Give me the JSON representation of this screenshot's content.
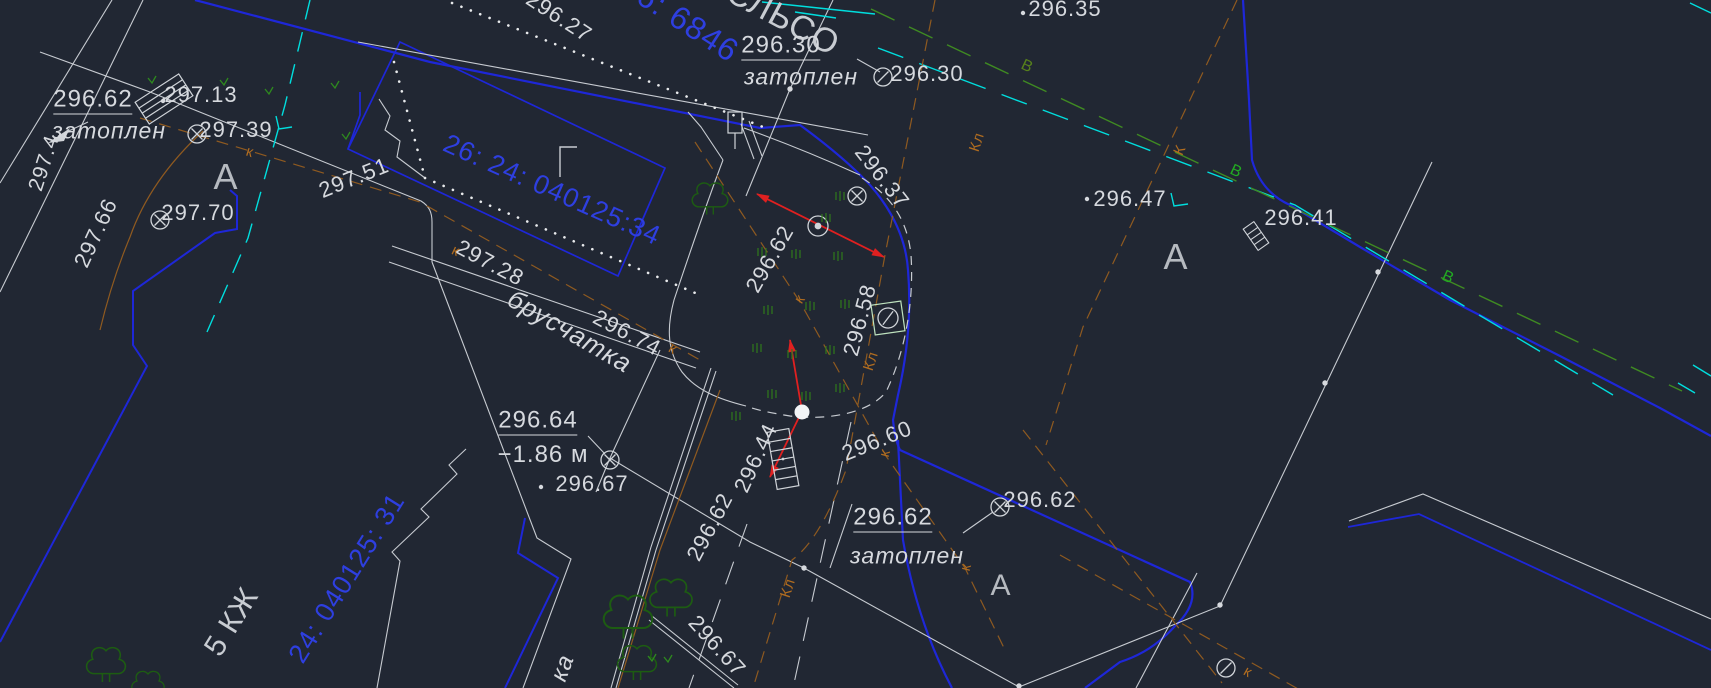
{
  "app": {
    "description": "CAD topographic survey plan viewport (dark theme), Russian annotations",
    "canvas": {
      "width": 1711,
      "height": 688,
      "background": "#212733"
    }
  },
  "colors": {
    "background": "#212733",
    "label_white": "#d6d9de",
    "label_letter": "#b6bac0",
    "line_white": "#c7cbd1",
    "blue_line": "#1e27d8",
    "blue_text": "#2e3fe0",
    "cyan": "#00dede",
    "green_line": "#3f8a22",
    "green_label_bright": "#22aa22",
    "green_label_olive": "#56801c",
    "tree_green": "#1d5c12",
    "grass_green": "#2f7a1c",
    "brown_line": "#8f5a20",
    "brown_label": "#b06c20",
    "red": "#e02020"
  },
  "icons": {
    "manhole-cross": "circle with diagonal cross — utility manhole",
    "manhole-slash": "circle with diagonal slash — utility manhole",
    "benchmark": "double concentric circle — survey point",
    "valve-square": "square with slashed circle — valve chamber",
    "steps": "hatched rectangle — steps / grate",
    "post": "small rectangle with stem — post / sign",
    "water-dot": "filled white dot — flooded point",
    "tree": "deciduous tree outline",
    "tuft": "grass tuft strokes",
    "vmark": "vegetation check mark",
    "corner-mark": "building corner letter mark"
  },
  "labels": [
    {
      "name": "elev-296-62-tl",
      "text": "296.62",
      "x": 93,
      "y": 101,
      "rot": 0,
      "size": 24,
      "color": "#d6d9de",
      "cls": "u"
    },
    {
      "name": "word-zatoplen-tl",
      "text": "затоплен",
      "x": 109,
      "y": 131,
      "rot": 0,
      "size": 23,
      "color": "#d6d9de",
      "cls": "it"
    },
    {
      "name": "elev-297-4",
      "text": "297.4",
      "x": 44,
      "y": 163,
      "rot": -72,
      "size": 21,
      "color": "#d6d9de",
      "cls": ""
    },
    {
      "name": "elev-297-66",
      "text": "297.66",
      "x": 96,
      "y": 233,
      "rot": -65,
      "size": 22,
      "color": "#d6d9de",
      "cls": ""
    },
    {
      "name": "elev-297-13",
      "text": "297.13",
      "x": 201,
      "y": 95,
      "rot": 0,
      "size": 22,
      "color": "#d6d9de",
      "cls": ""
    },
    {
      "name": "elev-297-39",
      "text": "297.39",
      "x": 236,
      "y": 130,
      "rot": 0,
      "size": 22,
      "color": "#d6d9de",
      "cls": ""
    },
    {
      "name": "letter-A-1",
      "text": "А",
      "x": 226,
      "y": 177,
      "rot": 0,
      "size": 36,
      "color": "#b6bac0",
      "cls": ""
    },
    {
      "name": "elev-297-70",
      "text": "297.70",
      "x": 198,
      "y": 213,
      "rot": 0,
      "size": 22,
      "color": "#d6d9de",
      "cls": ""
    },
    {
      "name": "elev-297-51",
      "text": "297.51",
      "x": 354,
      "y": 178,
      "rot": -22,
      "size": 22,
      "color": "#d6d9de",
      "cls": ""
    },
    {
      "name": "elev-296-27",
      "text": "296.27",
      "x": 559,
      "y": 17,
      "rot": 33,
      "size": 22,
      "color": "#d6d9de",
      "cls": ""
    },
    {
      "name": "cadastral-34",
      "text": "26: 24: 040125:34",
      "x": 552,
      "y": 190,
      "rot": 24,
      "size": 27,
      "color": "#2e3fe0",
      "cls": ""
    },
    {
      "name": "cadastral-6846",
      "text": "6: 6846",
      "x": 688,
      "y": 23,
      "rot": 33,
      "size": 32,
      "color": "#2e3fe0",
      "cls": ""
    },
    {
      "name": "street-name",
      "text": "СЛЬСО",
      "x": 783,
      "y": 18,
      "rot": 28,
      "size": 34,
      "color": "#c8ccd2",
      "cls": ""
    },
    {
      "name": "elev-296-30-u",
      "text": "296.30",
      "x": 781,
      "y": 47,
      "rot": 0,
      "size": 24,
      "color": "#d6d9de",
      "cls": "u"
    },
    {
      "name": "word-zatoplen-2",
      "text": "затоплен",
      "x": 801,
      "y": 77,
      "rot": 0,
      "size": 23,
      "color": "#d6d9de",
      "cls": "it"
    },
    {
      "name": "elev-296-30-r",
      "text": "296.30",
      "x": 927,
      "y": 74,
      "rot": 0,
      "size": 22,
      "color": "#d6d9de",
      "cls": ""
    },
    {
      "name": "elev-296-35",
      "text": "296.35",
      "x": 1065,
      "y": 9,
      "rot": 0,
      "size": 22,
      "color": "#d6d9de",
      "cls": ""
    },
    {
      "name": "elev-296-37",
      "text": "296.37",
      "x": 882,
      "y": 177,
      "rot": 52,
      "size": 22,
      "color": "#d6d9de",
      "cls": ""
    },
    {
      "name": "elev-296-47",
      "text": "296.47",
      "x": 1130,
      "y": 199,
      "rot": 0,
      "size": 22,
      "color": "#d6d9de",
      "cls": ""
    },
    {
      "name": "letter-A-2",
      "text": "А",
      "x": 1176,
      "y": 257,
      "rot": 0,
      "size": 36,
      "color": "#b6bac0",
      "cls": ""
    },
    {
      "name": "elev-296-41",
      "text": "296.41",
      "x": 1301,
      "y": 218,
      "rot": 0,
      "size": 22,
      "color": "#d6d9de",
      "cls": ""
    },
    {
      "name": "water-main-label-1",
      "text": "В",
      "x": 1027,
      "y": 67,
      "rot": 25,
      "size": 16,
      "color": "#56801c",
      "cls": ""
    },
    {
      "name": "water-main-label-2",
      "text": "В",
      "x": 1236,
      "y": 172,
      "rot": 25,
      "size": 16,
      "color": "#22aa22",
      "cls": ""
    },
    {
      "name": "water-main-label-3",
      "text": "В",
      "x": 1448,
      "y": 278,
      "rot": 25,
      "size": 16,
      "color": "#22aa22",
      "cls": ""
    },
    {
      "name": "elev-296-62-flood",
      "text": "296.62",
      "x": 770,
      "y": 259,
      "rot": -60,
      "size": 22,
      "color": "#d6d9de",
      "cls": ""
    },
    {
      "name": "elev-296-58",
      "text": "296.58",
      "x": 860,
      "y": 320,
      "rot": -75,
      "size": 22,
      "color": "#d6d9de",
      "cls": ""
    },
    {
      "name": "elev-296-60",
      "text": "296.60",
      "x": 877,
      "y": 441,
      "rot": -22,
      "size": 22,
      "color": "#d6d9de",
      "cls": ""
    },
    {
      "name": "elev-296-62-road",
      "text": "296.62",
      "x": 710,
      "y": 527,
      "rot": -62,
      "size": 22,
      "color": "#d6d9de",
      "cls": ""
    },
    {
      "name": "elev-296-44",
      "text": "296.44",
      "x": 756,
      "y": 458,
      "rot": -65,
      "size": 22,
      "color": "#d6d9de",
      "cls": ""
    },
    {
      "name": "elev-296-67-bot",
      "text": "296.67",
      "x": 717,
      "y": 646,
      "rot": 48,
      "size": 22,
      "color": "#d6d9de",
      "cls": ""
    },
    {
      "name": "word-ka",
      "text": "ка",
      "x": 563,
      "y": 668,
      "rot": -70,
      "size": 24,
      "color": "#d6d9de",
      "cls": "it"
    },
    {
      "name": "word-bruschatka",
      "text": "брусчатка",
      "x": 570,
      "y": 331,
      "rot": 30,
      "size": 26,
      "color": "#d6d9de",
      "cls": "it"
    },
    {
      "name": "elev-297-28",
      "text": "297.28",
      "x": 490,
      "y": 263,
      "rot": 28,
      "size": 22,
      "color": "#d6d9de",
      "cls": ""
    },
    {
      "name": "elev-296-74",
      "text": "296.74",
      "x": 627,
      "y": 333,
      "rot": 28,
      "size": 22,
      "color": "#d6d9de",
      "cls": ""
    },
    {
      "name": "elev-296-64",
      "text": "296.64",
      "x": 538,
      "y": 422,
      "rot": 0,
      "size": 24,
      "color": "#d6d9de",
      "cls": "u"
    },
    {
      "name": "depth-annotation",
      "text": "−1.86 м",
      "x": 543,
      "y": 455,
      "rot": 0,
      "size": 24,
      "color": "#d6d9de",
      "cls": ""
    },
    {
      "name": "elev-296-67-left",
      "text": "296.67",
      "x": 592,
      "y": 484,
      "rot": 0,
      "size": 22,
      "color": "#d6d9de",
      "cls": ""
    },
    {
      "name": "elev-296-62-center",
      "text": "296.62",
      "x": 893,
      "y": 519,
      "rot": 0,
      "size": 24,
      "color": "#d6d9de",
      "cls": "u"
    },
    {
      "name": "word-zatoplen-3",
      "text": "затоплен",
      "x": 907,
      "y": 556,
      "rot": 0,
      "size": 23,
      "color": "#d6d9de",
      "cls": "it"
    },
    {
      "name": "elev-296-62-right",
      "text": "296.62",
      "x": 1040,
      "y": 500,
      "rot": 0,
      "size": 22,
      "color": "#d6d9de",
      "cls": ""
    },
    {
      "name": "letter-A-3",
      "text": "А",
      "x": 1001,
      "y": 586,
      "rot": 0,
      "size": 30,
      "color": "#b6bac0",
      "cls": ""
    },
    {
      "name": "building-5kzh",
      "text": "5 КЖ",
      "x": 232,
      "y": 622,
      "rot": -58,
      "size": 30,
      "color": "#c8ccd2",
      "cls": ""
    },
    {
      "name": "cadastral-31",
      "text": "24: 040125: 31",
      "x": 347,
      "y": 578,
      "rot": -58,
      "size": 27,
      "color": "#2e3fe0",
      "cls": ""
    },
    {
      "name": "sewer-label-k1",
      "text": "к",
      "x": 250,
      "y": 152,
      "rot": 17,
      "size": 15,
      "color": "#b06c20",
      "cls": ""
    },
    {
      "name": "sewer-label-k2",
      "text": "к",
      "x": 456,
      "y": 251,
      "rot": 25,
      "size": 15,
      "color": "#b06c20",
      "cls": ""
    },
    {
      "name": "sewer-label-k3",
      "text": "к",
      "x": 673,
      "y": 349,
      "rot": 30,
      "size": 15,
      "color": "#b06c20",
      "cls": ""
    },
    {
      "name": "sewer-label-kl1",
      "text": "Кл",
      "x": 977,
      "y": 142,
      "rot": -72,
      "size": 15,
      "color": "#b06c20",
      "cls": ""
    },
    {
      "name": "sewer-label-K1",
      "text": "К",
      "x": 1180,
      "y": 150,
      "rot": -65,
      "size": 15,
      "color": "#b06c20",
      "cls": ""
    },
    {
      "name": "sewer-label-kl2",
      "text": "Кл",
      "x": 871,
      "y": 361,
      "rot": -72,
      "size": 15,
      "color": "#b06c20",
      "cls": ""
    },
    {
      "name": "sewer-label-k4",
      "text": "к",
      "x": 800,
      "y": 299,
      "rot": -55,
      "size": 15,
      "color": "#b06c20",
      "cls": ""
    },
    {
      "name": "sewer-label-k5",
      "text": "к",
      "x": 885,
      "y": 453,
      "rot": -75,
      "size": 15,
      "color": "#b06c20",
      "cls": ""
    },
    {
      "name": "sewer-label-k6",
      "text": "к",
      "x": 966,
      "y": 567,
      "rot": -75,
      "size": 15,
      "color": "#b06c20",
      "cls": ""
    },
    {
      "name": "sewer-label-kl3",
      "text": "Кл",
      "x": 788,
      "y": 588,
      "rot": -72,
      "size": 15,
      "color": "#b06c20",
      "cls": ""
    },
    {
      "name": "sewer-label-k7",
      "text": "к",
      "x": 1248,
      "y": 672,
      "rot": 30,
      "size": 15,
      "color": "#b06c20",
      "cls": ""
    }
  ],
  "symbols": [
    {
      "type": "manhole-cross",
      "x": 197,
      "y": 134,
      "rot": 0
    },
    {
      "type": "manhole-cross",
      "x": 160,
      "y": 220,
      "rot": 0
    },
    {
      "type": "manhole-cross",
      "x": 857,
      "y": 196,
      "rot": 0
    },
    {
      "type": "manhole-cross",
      "x": 610,
      "y": 460,
      "rot": 0
    },
    {
      "type": "manhole-cross",
      "x": 1000,
      "y": 507,
      "rot": 0
    },
    {
      "type": "manhole-slash",
      "x": 883,
      "y": 77,
      "rot": 0
    },
    {
      "type": "manhole-slash",
      "x": 1226,
      "y": 668,
      "rot": 0
    },
    {
      "type": "benchmark",
      "x": 818,
      "y": 226,
      "rot": 0
    },
    {
      "type": "valve-square",
      "x": 888,
      "y": 318,
      "rot": -8
    },
    {
      "type": "steps-large",
      "x": 164,
      "y": 99,
      "rot": -33
    },
    {
      "type": "steps-tall",
      "x": 783,
      "y": 459,
      "rot": -10
    },
    {
      "type": "steps-small",
      "x": 1256,
      "y": 236,
      "rot": -35
    },
    {
      "type": "post",
      "x": 735,
      "y": 122,
      "rot": 0
    },
    {
      "type": "corner-mark",
      "x": 560,
      "y": 147,
      "rot": 0
    },
    {
      "type": "water-dot",
      "x": 802,
      "y": 412,
      "rot": 0
    },
    {
      "type": "point-dot",
      "x": 163,
      "y": 101,
      "rot": 0
    },
    {
      "type": "point-dot",
      "x": 1023,
      "y": 13,
      "rot": 0
    },
    {
      "type": "point-dot",
      "x": 1087,
      "y": 199,
      "rot": 0
    },
    {
      "type": "point-dot",
      "x": 541,
      "y": 487,
      "rot": 0
    },
    {
      "type": "vertex-dot",
      "x": 790,
      "y": 89,
      "rot": 0
    },
    {
      "type": "vertex-dot",
      "x": 804,
      "y": 568,
      "rot": 0
    },
    {
      "type": "vertex-dot",
      "x": 1019,
      "y": 686,
      "rot": 0
    },
    {
      "type": "vertex-dot",
      "x": 1220,
      "y": 605,
      "rot": 0
    },
    {
      "type": "vertex-dot",
      "x": 1378,
      "y": 272,
      "rot": 0
    },
    {
      "type": "vertex-dot",
      "x": 1325,
      "y": 383,
      "rot": 0
    },
    {
      "type": "tree",
      "x": 710,
      "y": 198,
      "rot": 0,
      "s": 1.1
    },
    {
      "type": "tree",
      "x": 628,
      "y": 616,
      "rot": 0,
      "s": 1.5
    },
    {
      "type": "tree",
      "x": 671,
      "y": 597,
      "rot": 0,
      "s": 1.3
    },
    {
      "type": "tree",
      "x": 637,
      "y": 662,
      "rot": 0,
      "s": 1.2
    },
    {
      "type": "tree",
      "x": 106,
      "y": 664,
      "rot": 0,
      "s": 1.2
    },
    {
      "type": "tree",
      "x": 148,
      "y": 685,
      "rot": 0,
      "s": 1.0
    },
    {
      "type": "tuft",
      "x": 840,
      "y": 196,
      "rot": 0
    },
    {
      "type": "tuft",
      "x": 826,
      "y": 218,
      "rot": 0
    },
    {
      "type": "tuft",
      "x": 762,
      "y": 252,
      "rot": 0
    },
    {
      "type": "tuft",
      "x": 796,
      "y": 254,
      "rot": 0
    },
    {
      "type": "tuft",
      "x": 838,
      "y": 256,
      "rot": 0
    },
    {
      "type": "tuft",
      "x": 768,
      "y": 310,
      "rot": 0
    },
    {
      "type": "tuft",
      "x": 810,
      "y": 306,
      "rot": 0
    },
    {
      "type": "tuft",
      "x": 845,
      "y": 304,
      "rot": 0
    },
    {
      "type": "tuft",
      "x": 757,
      "y": 348,
      "rot": 0
    },
    {
      "type": "tuft",
      "x": 792,
      "y": 354,
      "rot": 0
    },
    {
      "type": "tuft",
      "x": 830,
      "y": 350,
      "rot": 0
    },
    {
      "type": "tuft",
      "x": 772,
      "y": 394,
      "rot": 0
    },
    {
      "type": "tuft",
      "x": 806,
      "y": 396,
      "rot": 0
    },
    {
      "type": "tuft",
      "x": 840,
      "y": 388,
      "rot": 0
    },
    {
      "type": "tuft",
      "x": 736,
      "y": 416,
      "rot": 0
    },
    {
      "type": "vmark",
      "x": 224,
      "y": 82,
      "rot": 0
    },
    {
      "type": "vmark",
      "x": 269,
      "y": 91,
      "rot": 0
    },
    {
      "type": "vmark",
      "x": 152,
      "y": 80,
      "rot": 0
    },
    {
      "type": "vmark",
      "x": 346,
      "y": 136,
      "rot": 0
    },
    {
      "type": "vmark",
      "x": 335,
      "y": 85,
      "rot": 0
    },
    {
      "type": "vmark",
      "x": 652,
      "y": 658,
      "rot": 0
    },
    {
      "type": "vmark",
      "x": 668,
      "y": 659,
      "rot": 0
    }
  ]
}
